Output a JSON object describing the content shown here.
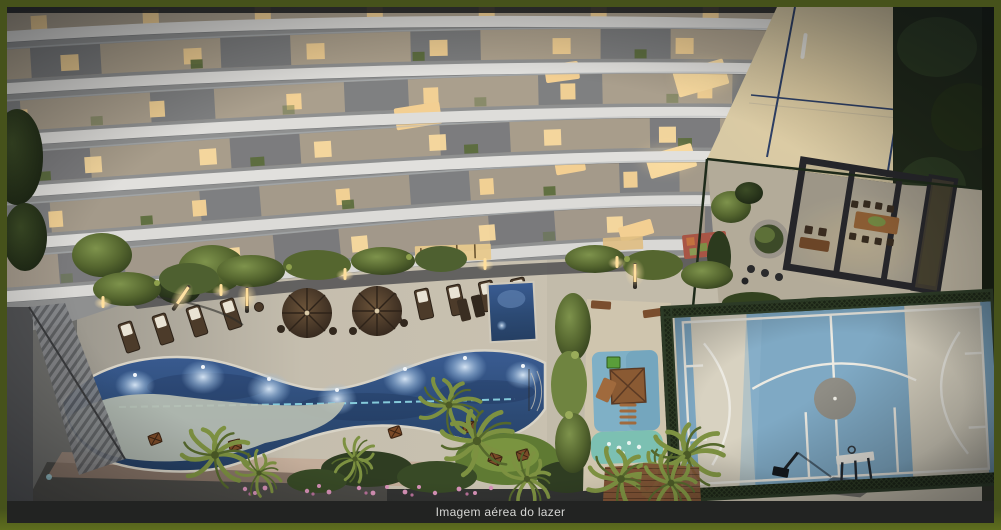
{
  "caption": {
    "text": "Imagem aérea do lazer"
  },
  "colors": {
    "frame": "#46521b",
    "frame_bottom": "#5f6e1e",
    "caption_bg": "#222322",
    "caption_text": "#d6d6d4",
    "pool_water": "#2c4a74",
    "pool_lane": "#8fd9e6",
    "court_blue": "#7fa9c4",
    "court_beige": "#d8d2c1",
    "court_line": "#eceae2",
    "sand": "#d8c9a4",
    "slab_white": "#e0dfdc",
    "facade_gray": "#8f9090",
    "window_warm": "#f7d79a",
    "foliage_green": "#5d7038",
    "wood_brown": "#8a5a38"
  }
}
